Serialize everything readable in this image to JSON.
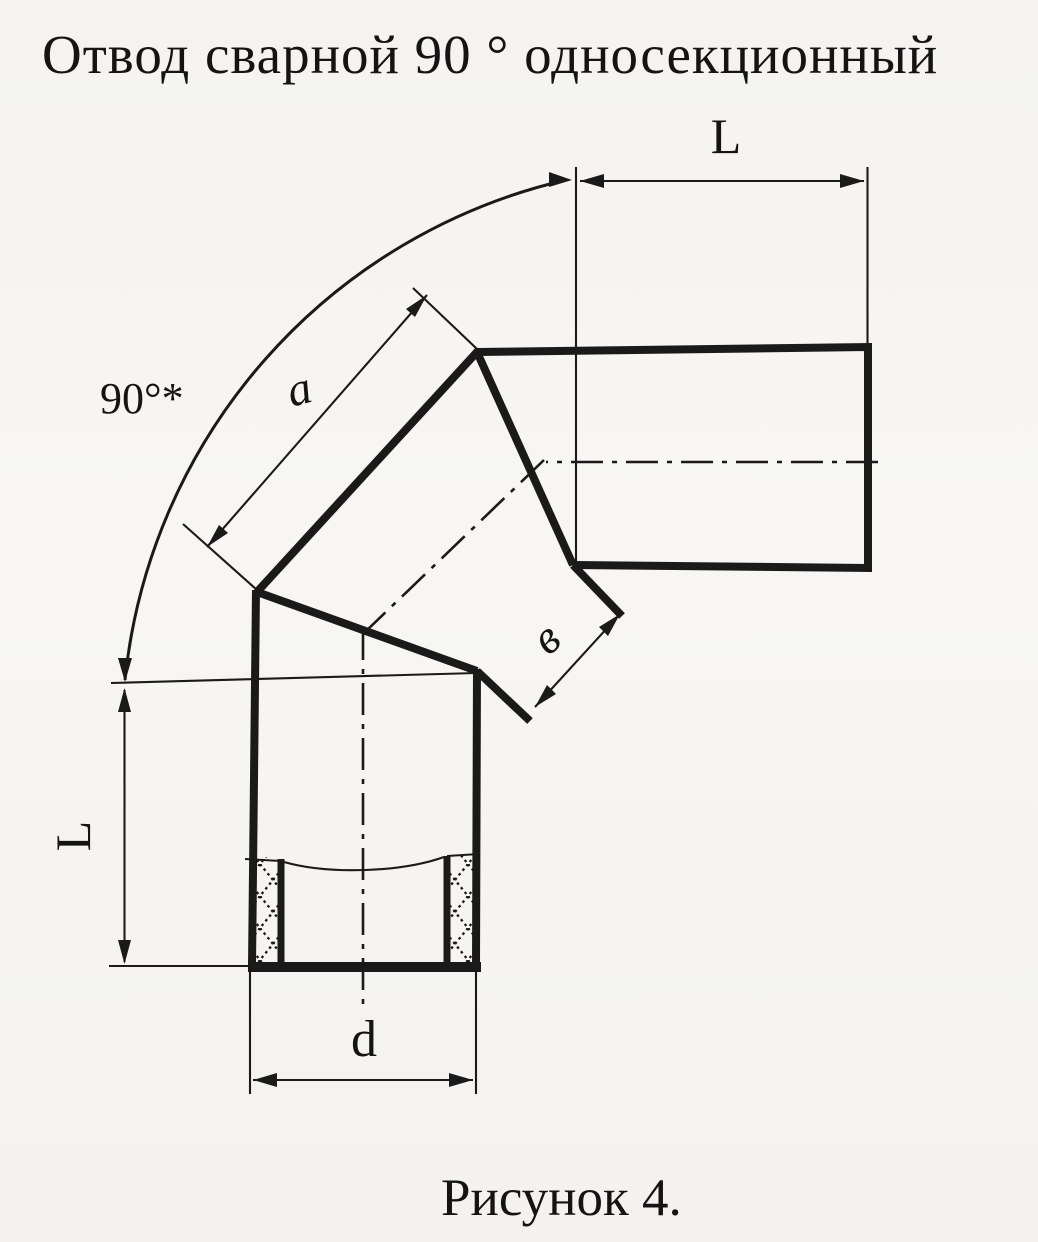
{
  "title": "Отвод сварной 90 ° односекционный",
  "caption": "Рисунок 4.",
  "colors": {
    "ink": "#1a1a1a",
    "paper": "#f6f5f1"
  },
  "dimensions": {
    "angle_label": "90°*",
    "top_length_label": "L",
    "left_length_label": "L",
    "segment_a_label": "a",
    "joint_width_label": "в",
    "diameter_label": "d"
  }
}
